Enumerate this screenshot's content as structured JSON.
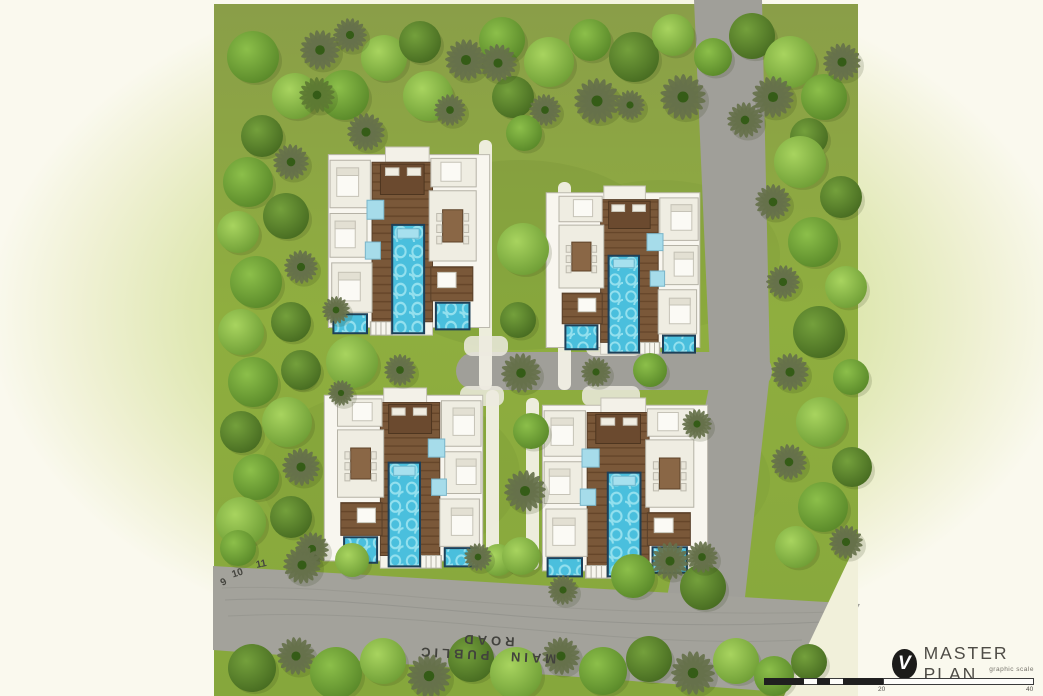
{
  "title_block": {
    "logo_icon": "checkmark-circle-icon",
    "logo_glyph": "V",
    "title": "MASTER PLAN",
    "subtitle": "graphic scale",
    "scale_ticks": [
      "20",
      "40"
    ]
  },
  "labels": {
    "road": "MAIN PUBLIC ROAD",
    "contours": [
      "9",
      "10",
      "11"
    ]
  },
  "colors": {
    "site_green": "#8fae3f",
    "site_olive": "#8a9e48",
    "road_gray": "#a09f99",
    "main_road_gray": "#a3a29b",
    "pool_blue": "#4abfdd",
    "pool_border": "#1d4059",
    "deck_brown": "#7a5839",
    "villa_white": "#f8f6ef",
    "background_cream": "#faf9ee",
    "glow_green": "#cedd96",
    "logo_black": "#1c1c1a",
    "title_gray": "#4e4c46"
  },
  "map": {
    "shapes": [
      {
        "n": "site-area",
        "tag": "path",
        "d": "M214,4 L858,4 L858,548 L790,696 L214,696 Z",
        "fill": "url(#siteG)"
      },
      {
        "n": "grass-shade",
        "tag": "ellipse",
        "cx": 520,
        "cy": 255,
        "rx": 150,
        "ry": 95,
        "fill": "#6e8c31",
        "opacity": 0.22
      },
      {
        "n": "grass-shade",
        "tag": "ellipse",
        "cx": 390,
        "cy": 475,
        "rx": 130,
        "ry": 85,
        "fill": "#6e8c31",
        "opacity": 0.18
      },
      {
        "n": "grass-shade",
        "tag": "ellipse",
        "cx": 660,
        "cy": 255,
        "rx": 120,
        "ry": 75,
        "fill": "#6e8c31",
        "opacity": 0.16
      },
      {
        "n": "grass-shade",
        "tag": "ellipse",
        "cx": 650,
        "cy": 480,
        "rx": 120,
        "ry": 75,
        "fill": "#6e8c31",
        "opacity": 0.16
      },
      {
        "n": "road-entry",
        "tag": "path",
        "d": "M694,0 L762,0 L770,368 L710,368 Z",
        "fill": "#a09f99"
      },
      {
        "n": "road-central",
        "tag": "rect",
        "x": 456,
        "y": 352,
        "w": 316,
        "h": 38,
        "rx": 19,
        "fill": "#a09f99"
      },
      {
        "n": "road-east",
        "tag": "path",
        "d": "M712,372 L770,372 L744,606 L666,602 Z",
        "fill": "#a09f99"
      },
      {
        "n": "road-main-public",
        "tag": "path",
        "d": "M213,566 L860,604 L808,694 L213,650 Z",
        "fill": "#a3a29b"
      },
      {
        "n": "contour-line",
        "tag": "path",
        "d": "M222,588 C360,582 520,620 840,612",
        "stroke": "#8b8b85",
        "sw": 1,
        "fill": "none",
        "opacity": 0.4
      },
      {
        "n": "contour-line",
        "tag": "path",
        "d": "M225,600 C380,592 560,636 822,622",
        "stroke": "#8b8b85",
        "sw": 1,
        "fill": "none",
        "opacity": 0.55
      },
      {
        "n": "contour-line",
        "tag": "path",
        "d": "M228,616 C420,606 600,650 802,640",
        "stroke": "#8b8b85",
        "sw": 1,
        "fill": "none",
        "opacity": 0.45
      },
      {
        "n": "walkway",
        "tag": "rect",
        "x": 479,
        "y": 140,
        "w": 13,
        "h": 250,
        "rx": 6,
        "fill": "#f2f0e5",
        "opacity": 0.95
      },
      {
        "n": "walkway",
        "tag": "rect",
        "x": 558,
        "y": 182,
        "w": 13,
        "h": 208,
        "rx": 6,
        "fill": "#f2f0e5",
        "opacity": 0.95
      },
      {
        "n": "walkway",
        "tag": "rect",
        "x": 486,
        "y": 390,
        "w": 13,
        "h": 180,
        "rx": 6,
        "fill": "#f2f0e5",
        "opacity": 0.95
      },
      {
        "n": "walkway",
        "tag": "rect",
        "x": 526,
        "y": 398,
        "w": 13,
        "h": 172,
        "rx": 6,
        "fill": "#f2f0e5",
        "opacity": 0.95
      },
      {
        "n": "driveway-apron",
        "tag": "rect",
        "x": 464,
        "y": 336,
        "w": 44,
        "h": 20,
        "rx": 8,
        "fill": "#eceadf",
        "opacity": 0.85
      },
      {
        "n": "driveway-apron",
        "tag": "rect",
        "x": 586,
        "y": 336,
        "w": 56,
        "h": 20,
        "rx": 8,
        "fill": "#eceadf",
        "opacity": 0.85
      },
      {
        "n": "driveway-apron",
        "tag": "rect",
        "x": 460,
        "y": 386,
        "w": 44,
        "h": 20,
        "rx": 8,
        "fill": "#eceadf",
        "opacity": 0.85
      },
      {
        "n": "driveway-apron",
        "tag": "rect",
        "x": 582,
        "y": 386,
        "w": 58,
        "h": 20,
        "rx": 8,
        "fill": "#eceadf",
        "opacity": 0.85
      },
      {
        "n": "boundary-cut",
        "tag": "path",
        "d": "M858,540 L858,696 L784,696 Z",
        "fill": "#f1f0da"
      }
    ],
    "villas": [
      {
        "x": 325,
        "y": 147,
        "w": 168,
        "h": 190,
        "m": false
      },
      {
        "x": 543,
        "y": 186,
        "w": 160,
        "h": 170,
        "m": true
      },
      {
        "x": 321,
        "y": 388,
        "w": 165,
        "h": 182,
        "m": true
      },
      {
        "x": 539,
        "y": 398,
        "w": 172,
        "h": 182,
        "m": false
      }
    ],
    "villa_template": [
      {
        "k": "base",
        "x": 2,
        "y": 4,
        "w": 96,
        "h": 91
      },
      {
        "k": "terrace",
        "x": 36,
        "y": 0,
        "w": 26,
        "h": 8
      },
      {
        "k": "apron",
        "x": 34,
        "y": 90,
        "w": 30,
        "h": 9
      },
      {
        "k": "deck",
        "x": 28,
        "y": 8,
        "w": 36,
        "h": 84
      },
      {
        "k": "pavilion",
        "x": 33,
        "y": 9,
        "w": 26,
        "h": 16
      },
      {
        "k": "sofa",
        "x": 36,
        "y": 11,
        "w": 8,
        "h": 4
      },
      {
        "k": "sofa",
        "x": 49,
        "y": 11,
        "w": 8,
        "h": 4
      },
      {
        "k": "room",
        "x": 3,
        "y": 7,
        "w": 24,
        "h": 25
      },
      {
        "k": "bed",
        "x": 7,
        "y": 11,
        "w": 13,
        "h": 15
      },
      {
        "k": "pillow",
        "x": 7,
        "y": 11,
        "w": 13,
        "h": 4
      },
      {
        "k": "room",
        "x": 3,
        "y": 35,
        "w": 22,
        "h": 23
      },
      {
        "k": "bed",
        "x": 6,
        "y": 39,
        "w": 12,
        "h": 14
      },
      {
        "k": "pillow",
        "x": 6,
        "y": 39,
        "w": 12,
        "h": 4
      },
      {
        "k": "room",
        "x": 4,
        "y": 61,
        "w": 24,
        "h": 26
      },
      {
        "k": "bed",
        "x": 8,
        "y": 66,
        "w": 13,
        "h": 15
      },
      {
        "k": "pillow",
        "x": 8,
        "y": 66,
        "w": 13,
        "h": 4
      },
      {
        "k": "bath",
        "x": 25,
        "y": 28,
        "w": 10,
        "h": 10
      },
      {
        "k": "bath",
        "x": 24,
        "y": 50,
        "w": 9,
        "h": 9
      },
      {
        "k": "room",
        "x": 62,
        "y": 23,
        "w": 28,
        "h": 37
      },
      {
        "k": "table",
        "x": 70,
        "y": 33,
        "w": 12,
        "h": 17
      },
      {
        "k": "chair",
        "x": 66.5,
        "y": 35,
        "w": 3,
        "h": 4
      },
      {
        "k": "chair",
        "x": 66.5,
        "y": 41,
        "w": 3,
        "h": 4
      },
      {
        "k": "chair",
        "x": 66.5,
        "y": 47,
        "w": 3,
        "h": 4
      },
      {
        "k": "chair",
        "x": 82.5,
        "y": 35,
        "w": 3,
        "h": 4
      },
      {
        "k": "chair",
        "x": 82.5,
        "y": 41,
        "w": 3,
        "h": 4
      },
      {
        "k": "chair",
        "x": 82.5,
        "y": 47,
        "w": 3,
        "h": 4
      },
      {
        "k": "room",
        "x": 63,
        "y": 6,
        "w": 27,
        "h": 15
      },
      {
        "k": "bed",
        "x": 69,
        "y": 8,
        "w": 12,
        "h": 10
      },
      {
        "k": "deck2",
        "x": 63,
        "y": 63,
        "w": 25,
        "h": 18
      },
      {
        "k": "bed",
        "x": 67,
        "y": 66,
        "w": 11,
        "h": 8
      },
      {
        "k": "steps",
        "x": 27,
        "y": 92,
        "w": 13,
        "h": 7
      },
      {
        "k": "pool",
        "x": 40,
        "y": 41,
        "w": 19,
        "h": 57
      },
      {
        "k": "poolstep",
        "x": 43,
        "y": 43,
        "w": 13,
        "h": 5
      },
      {
        "k": "pool",
        "x": 66,
        "y": 82,
        "w": 20,
        "h": 14
      },
      {
        "k": "pool",
        "x": 5,
        "y": 88,
        "w": 20,
        "h": 10
      }
    ],
    "trees": [
      [
        253,
        57,
        26,
        1,
        0
      ],
      [
        295,
        96,
        23,
        0,
        0
      ],
      [
        262,
        136,
        21,
        2,
        0
      ],
      [
        320,
        50,
        20,
        3,
        1
      ],
      [
        344,
        95,
        25,
        1,
        0
      ],
      [
        384,
        58,
        23,
        0,
        0
      ],
      [
        366,
        132,
        19,
        3,
        1
      ],
      [
        420,
        42,
        21,
        2,
        0
      ],
      [
        428,
        96,
        25,
        0,
        0
      ],
      [
        466,
        60,
        21,
        3,
        1
      ],
      [
        502,
        40,
        23,
        1,
        0
      ],
      [
        513,
        97,
        21,
        2,
        0
      ],
      [
        549,
        62,
        25,
        0,
        0
      ],
      [
        590,
        40,
        21,
        1,
        0
      ],
      [
        597,
        101,
        23,
        3,
        1
      ],
      [
        634,
        57,
        25,
        2,
        0
      ],
      [
        673,
        35,
        21,
        0,
        0
      ],
      [
        683,
        97,
        23,
        3,
        1
      ],
      [
        713,
        57,
        19,
        1,
        0
      ],
      [
        752,
        36,
        23,
        2,
        0
      ],
      [
        790,
        62,
        26,
        0,
        0
      ],
      [
        824,
        97,
        23,
        1,
        0
      ],
      [
        773,
        97,
        21,
        3,
        1
      ],
      [
        809,
        137,
        19,
        2,
        0
      ],
      [
        842,
        62,
        19,
        3,
        1
      ],
      [
        317,
        95,
        18,
        2,
        1
      ],
      [
        350,
        35,
        17,
        3,
        1
      ],
      [
        450,
        110,
        16,
        3,
        1
      ],
      [
        545,
        110,
        16,
        3,
        1
      ],
      [
        630,
        105,
        15,
        3,
        1
      ],
      [
        745,
        120,
        18,
        3,
        1
      ],
      [
        248,
        182,
        25,
        1,
        0
      ],
      [
        291,
        162,
        18,
        3,
        1
      ],
      [
        238,
        232,
        21,
        0,
        0
      ],
      [
        286,
        216,
        23,
        2,
        0
      ],
      [
        256,
        282,
        26,
        1,
        0
      ],
      [
        301,
        267,
        17,
        3,
        1
      ],
      [
        241,
        332,
        23,
        0,
        0
      ],
      [
        291,
        322,
        20,
        2,
        0
      ],
      [
        253,
        382,
        25,
        1,
        0
      ],
      [
        299,
        372,
        17,
        3,
        1
      ],
      [
        241,
        432,
        21,
        2,
        0
      ],
      [
        287,
        422,
        25,
        0,
        0
      ],
      [
        256,
        477,
        23,
        1,
        0
      ],
      [
        301,
        467,
        19,
        3,
        1
      ],
      [
        241,
        522,
        25,
        0,
        0
      ],
      [
        291,
        517,
        21,
        2,
        0
      ],
      [
        238,
        548,
        18,
        1,
        0
      ],
      [
        312,
        549,
        17,
        3,
        1
      ],
      [
        800,
        162,
        26,
        0,
        0
      ],
      [
        841,
        197,
        21,
        2,
        0
      ],
      [
        773,
        202,
        18,
        3,
        1
      ],
      [
        813,
        242,
        25,
        1,
        0
      ],
      [
        846,
        287,
        21,
        0,
        0
      ],
      [
        783,
        282,
        17,
        3,
        1
      ],
      [
        819,
        332,
        26,
        2,
        0
      ],
      [
        851,
        377,
        18,
        1,
        0
      ],
      [
        790,
        372,
        19,
        3,
        1
      ],
      [
        821,
        422,
        25,
        0,
        0
      ],
      [
        852,
        467,
        20,
        2,
        0
      ],
      [
        789,
        462,
        18,
        3,
        1
      ],
      [
        823,
        507,
        25,
        1,
        0
      ],
      [
        796,
        547,
        21,
        0,
        0
      ],
      [
        846,
        542,
        17,
        3,
        1
      ],
      [
        252,
        668,
        24,
        2,
        0
      ],
      [
        296,
        656,
        19,
        3,
        1
      ],
      [
        336,
        673,
        26,
        1,
        0
      ],
      [
        383,
        661,
        23,
        0,
        0
      ],
      [
        429,
        676,
        22,
        3,
        1
      ],
      [
        471,
        659,
        23,
        2,
        0
      ],
      [
        516,
        673,
        26,
        0,
        0
      ],
      [
        561,
        656,
        19,
        3,
        1
      ],
      [
        603,
        671,
        24,
        1,
        0
      ],
      [
        649,
        659,
        23,
        2,
        0
      ],
      [
        693,
        673,
        22,
        3,
        1
      ],
      [
        736,
        661,
        23,
        0,
        0
      ],
      [
        774,
        676,
        20,
        1,
        0
      ],
      [
        809,
        662,
        18,
        2,
        0
      ],
      [
        302,
        565,
        19,
        3,
        1
      ],
      [
        352,
        560,
        17,
        0,
        0
      ],
      [
        633,
        576,
        22,
        1,
        0
      ],
      [
        670,
        561,
        19,
        3,
        1
      ],
      [
        703,
        587,
        23,
        2,
        0
      ],
      [
        563,
        590,
        15,
        3,
        1
      ],
      [
        498,
        560,
        16,
        0,
        0
      ],
      [
        498,
        63,
        19,
        3,
        1
      ],
      [
        524,
        133,
        18,
        1,
        0
      ],
      [
        523,
        249,
        26,
        0,
        0
      ],
      [
        518,
        320,
        18,
        2,
        0
      ],
      [
        521,
        373,
        20,
        3,
        1
      ],
      [
        531,
        431,
        18,
        1,
        0
      ],
      [
        525,
        491,
        21,
        3,
        1
      ],
      [
        521,
        556,
        19,
        0,
        0
      ],
      [
        352,
        362,
        26,
        0,
        0
      ],
      [
        301,
        370,
        20,
        2,
        0
      ],
      [
        400,
        370,
        16,
        3,
        1
      ],
      [
        336,
        310,
        14,
        3,
        1
      ],
      [
        697,
        424,
        15,
        3,
        1
      ],
      [
        341,
        393,
        13,
        3,
        1
      ],
      [
        702,
        557,
        16,
        3,
        1
      ],
      [
        478,
        557,
        14,
        3,
        1
      ],
      [
        596,
        372,
        15,
        3,
        1
      ],
      [
        650,
        370,
        17,
        1,
        0
      ]
    ]
  }
}
